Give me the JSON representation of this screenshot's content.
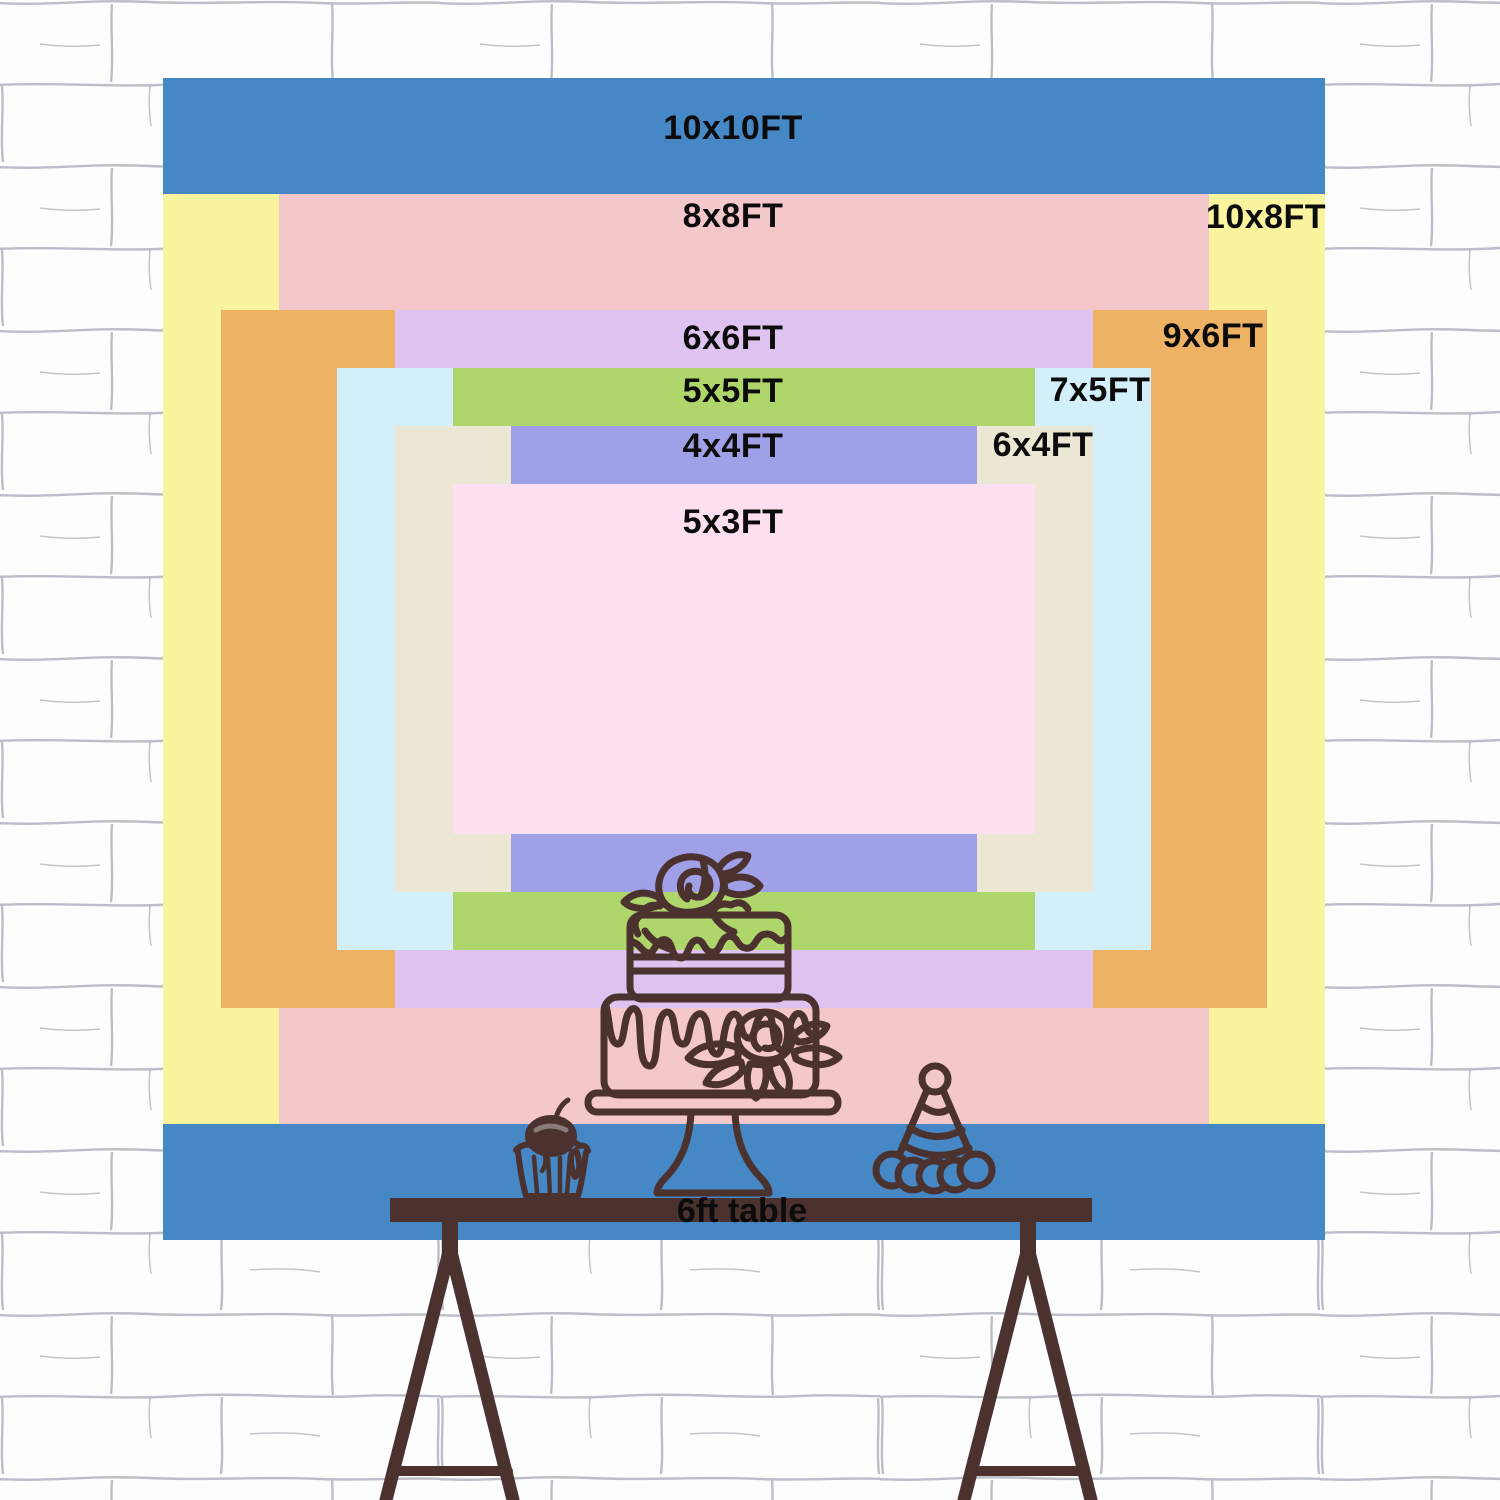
{
  "page": {
    "type": "backdrop-size-comparison-diagram",
    "text_color": "#0c0c0c"
  },
  "wall": {
    "name": "white-brick-wall",
    "background": "#fdfdfe",
    "mortar_line_color": "#a6a9b4"
  },
  "backdrop": {
    "layers": [
      {
        "id": "10x10ft",
        "label": "10x10FT",
        "width_ft": 10,
        "height_ft": 10,
        "color": "#4687c6"
      },
      {
        "id": "10x8ft",
        "label": "10x8FT",
        "width_ft": 10,
        "height_ft": 8,
        "color": "#fbf49f"
      },
      {
        "id": "8x8ft",
        "label": "8x8FT",
        "width_ft": 8,
        "height_ft": 8,
        "color": "#f4c8ca"
      },
      {
        "id": "9x6ft",
        "label": "9x6FT",
        "width_ft": 9,
        "height_ft": 6,
        "color": "#edb263"
      },
      {
        "id": "6x6ft",
        "label": "6x6FT",
        "width_ft": 6,
        "height_ft": 6,
        "color": "#dec2f0"
      },
      {
        "id": "7x5ft",
        "label": "7x5FT",
        "width_ft": 7,
        "height_ft": 5,
        "color": "#d2effa"
      },
      {
        "id": "5x5ft",
        "label": "5x5FT",
        "width_ft": 5,
        "height_ft": 5,
        "color": "#aed66b"
      },
      {
        "id": "6x4ft",
        "label": "6x4FT",
        "width_ft": 6,
        "height_ft": 4,
        "color": "#ece6d4"
      },
      {
        "id": "4x4ft",
        "label": "4x4FT",
        "width_ft": 4,
        "height_ft": 4,
        "color": "#9fa0e8"
      },
      {
        "id": "5x3ft",
        "label": "5x3FT",
        "width_ft": 5,
        "height_ft": 3,
        "color": "#fde0f0"
      }
    ]
  },
  "table": {
    "label": "6ft table",
    "length_ft": 6,
    "color": "#4b322f"
  },
  "illustration": {
    "line_color": "#4b322f",
    "items": [
      "two-tier-cake-on-stand",
      "cupcake-with-cherry",
      "party-hat"
    ]
  }
}
